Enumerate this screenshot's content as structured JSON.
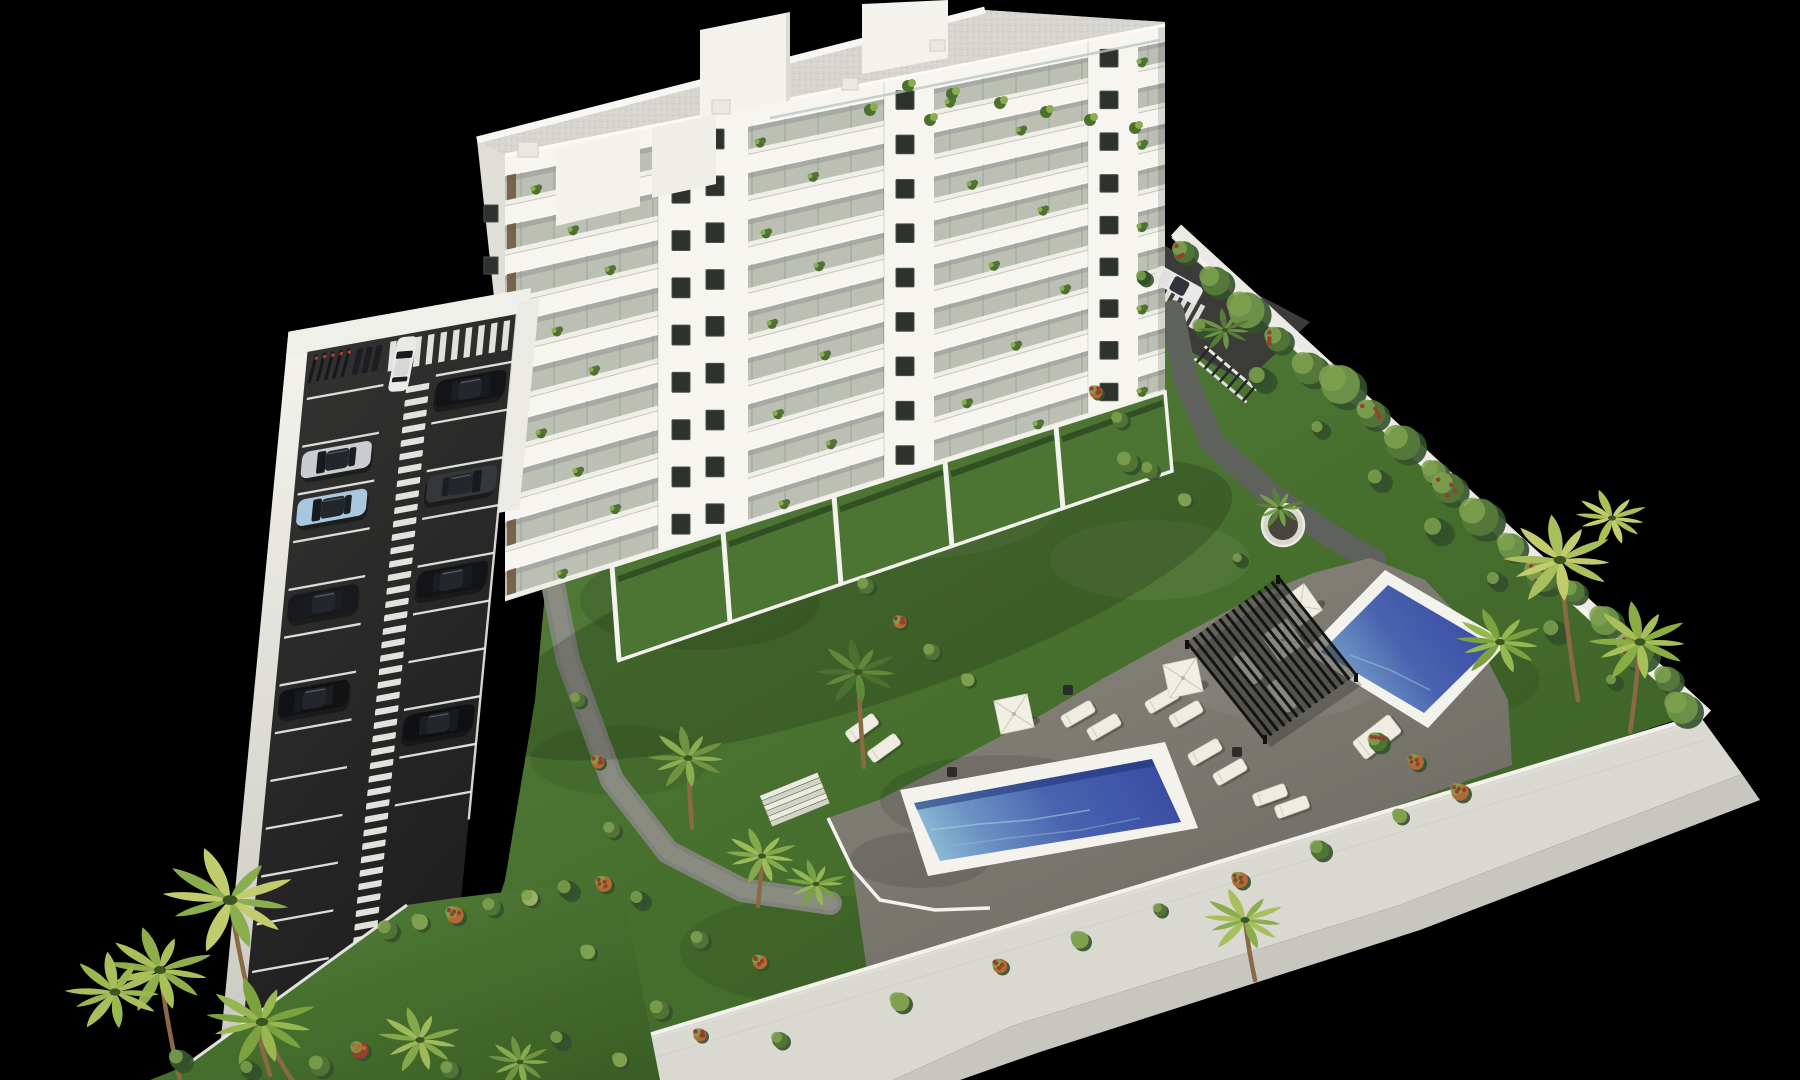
{
  "scene": {
    "description": "Aerial 3D architectural rendering on a black background: a white nine-storey apartment building with glass balconies and rooftop terraces, a walled asphalt parking lot with white stall markings, a ladder-style pedestrian path, a zebra crosswalk and eight cars, landscaped lawns with palm trees and flowering hedges, a stone sun deck with white parasols and loungers, a dark slatted pergola, a long blue lap pool and a smaller plunge pool, all enclosed by white perimeter walls.",
    "style": "photorealistic daylight render, isometric aerial view",
    "background": "#000000",
    "colors": {
      "bg": "#000000",
      "facade": "#f6f5f0",
      "facadeShade": "#e8e6de",
      "endWall": "#edebe3",
      "slab": "#efeee7",
      "glass": "#aebbb6",
      "glassLine": "#8fa09a",
      "stone": "#c3bfae",
      "interior": "#7c7466",
      "wood": "#6e523a",
      "windowDark": "#2e322e",
      "windowFrame": "#4a4f49",
      "roofGravel": "#d6d5cf",
      "parapet": "#f7f6f2",
      "roofBox": "#f3f2ec",
      "asphalt": "#2a2a29",
      "asphaltDark": "#1f1f1f",
      "marking": "#ebebe8",
      "wallLight": "#eceae4",
      "wallMid": "#d9d8d1",
      "wallShade": "#c7c6bf",
      "grassHi": "#5a8340",
      "grass": "#47702e",
      "grassLo": "#3a5f25",
      "deckHi": "#8a887e",
      "deckLo": "#6c6a62",
      "path": "#808379",
      "pathDark": "#5f625c",
      "poolDeep": "#3a4da3",
      "poolMid": "#4a63b0",
      "poolLight": "#8fc0d6",
      "coping": "#f3f2ec",
      "pergola": "#232323",
      "pergolaSlat": "#141414",
      "umbrella": "#f1eee4",
      "lounger": "#efede3",
      "loungerEdge": "#d8d5c7",
      "tableDark": "#2c2c2a",
      "palmA": "#6f9340",
      "palmB": "#8aad4e",
      "palmC": "#a9bf5e",
      "palmD": "#c2cc6d",
      "palmDk": "#4c7030",
      "bushG": "#517436",
      "bushD": "#33512a",
      "bushL": "#7fa14f",
      "accentO": "#b06a33",
      "accentR": "#963f2c",
      "trunk": "#8a6a45",
      "carWhite": "#e9eae8",
      "carSilver": "#c9cdd0",
      "carBlue": "#a8c6de",
      "carBlack1": "#17191c",
      "carBlack2": "#121417",
      "carBlack3": "#101214",
      "carBlack4": "#0e1013",
      "carGrey": "#35383b"
    },
    "building": {
      "floors": 9,
      "balcony_rows": 9,
      "facade_finish": "white with glass balconies and planters",
      "roof": "grey gravel roof with white stair cores and vents"
    },
    "parking": {
      "left_stall_rows": 14,
      "right_stall_rows": 10,
      "features": [
        "ladder pedestrian path",
        "zebra crosswalk",
        "bike racks",
        "motorbike bays",
        "white perimeter wall"
      ],
      "cars": [
        {
          "body": "white",
          "colorKey": "carWhite",
          "area": "lane"
        },
        {
          "body": "silver",
          "colorKey": "carSilver",
          "area": "left",
          "slot": 1
        },
        {
          "body": "light-blue",
          "colorKey": "carBlue",
          "area": "left",
          "slot": 2
        },
        {
          "body": "black",
          "colorKey": "carBlack1",
          "area": "left",
          "slot": 4
        },
        {
          "body": "black",
          "colorKey": "carBlack3",
          "area": "left",
          "slot": 6
        },
        {
          "body": "black",
          "colorKey": "carBlack2",
          "area": "right",
          "slot": 0
        },
        {
          "body": "grey",
          "colorKey": "carGrey",
          "area": "right",
          "slot": 2
        },
        {
          "body": "black",
          "colorKey": "carBlack2",
          "area": "right",
          "slot": 4
        },
        {
          "body": "black",
          "colorKey": "carBlack4",
          "area": "right",
          "slot": 7
        }
      ],
      "road_car": {
        "body": "white",
        "colorKey": "carWhite",
        "area": "rear access road"
      }
    },
    "garden": {
      "pools": [
        {
          "name": "lap pool"
        },
        {
          "name": "plunge pool"
        }
      ],
      "umbrellas": 4,
      "sun_loungers": 11,
      "daybeds": 1,
      "side_tables": 3,
      "pergola": 1,
      "round_planters": 1,
      "stairs": 1,
      "palm_trees": 16,
      "hedge_rows": 2
    }
  }
}
